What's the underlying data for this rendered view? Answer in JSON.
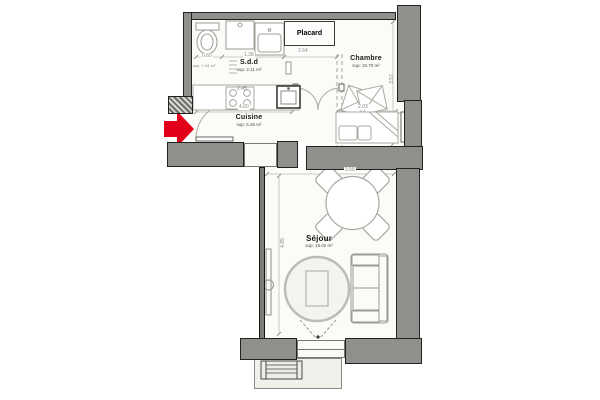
{
  "plan": {
    "rooms": {
      "sdd": {
        "name": "S.d.d",
        "area": "sup: 2.11 m²"
      },
      "placard": {
        "name": "Placard"
      },
      "chambre": {
        "name": "Chambre",
        "area": "sup: 10.70 m²"
      },
      "cuisine": {
        "name": "Cuisine",
        "area": "sup: 6.26 m²"
      },
      "sejour": {
        "name": "Séjour",
        "area": "sup: 18.02 m²"
      },
      "entry": {
        "area": "sup: 1.04 m²"
      }
    },
    "dimensions": {
      "chain_wc": "0.60",
      "chain_sdd": "1.38",
      "chain_placard": "2.64",
      "counter_run": "2.45",
      "cuisine_width": "4.00",
      "chambre_bed_width": "2.03",
      "chambre_depth": "3.57",
      "sejour_width": "3.58",
      "sejour_depth": "4.85"
    },
    "colors": {
      "wall": "#8f8f8c",
      "entrance_arrow": "#e2001a",
      "floor": "#fbfbf8"
    }
  }
}
